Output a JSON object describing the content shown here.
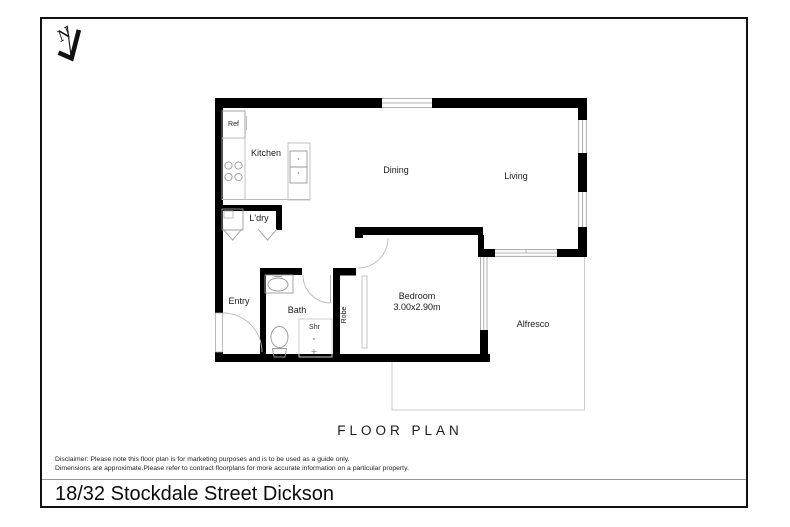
{
  "title_bar": {
    "address": "18/32 Stockdale Street Dickson"
  },
  "heading": {
    "floor_plan": "FLOOR PLAN"
  },
  "disclaimer": {
    "line1": "Disclaimer: Please note this floor plan is for marketing purposes and is to be used as a guide only.",
    "line2": "Dimensions are approximate.Please refer to contract floorplans for more accurate information on a particular property."
  },
  "north_arrow": {
    "label": "N"
  },
  "rooms": {
    "kitchen": "Kitchen",
    "dining": "Dining",
    "living": "Living",
    "laundry": "L'dry",
    "entry": "Entry",
    "bath": "Bath",
    "shower": "Shr",
    "robe": "Robe",
    "bedroom": "Bedroom",
    "bedroom_dims": "3.00x2.90m",
    "alfresco": "Alfresco"
  },
  "fixtures": {
    "fridge": "Ref"
  },
  "colors": {
    "wall": "#000000",
    "fixture_line": "#999999",
    "faint_line": "#cccccc",
    "frame": "#111111"
  }
}
